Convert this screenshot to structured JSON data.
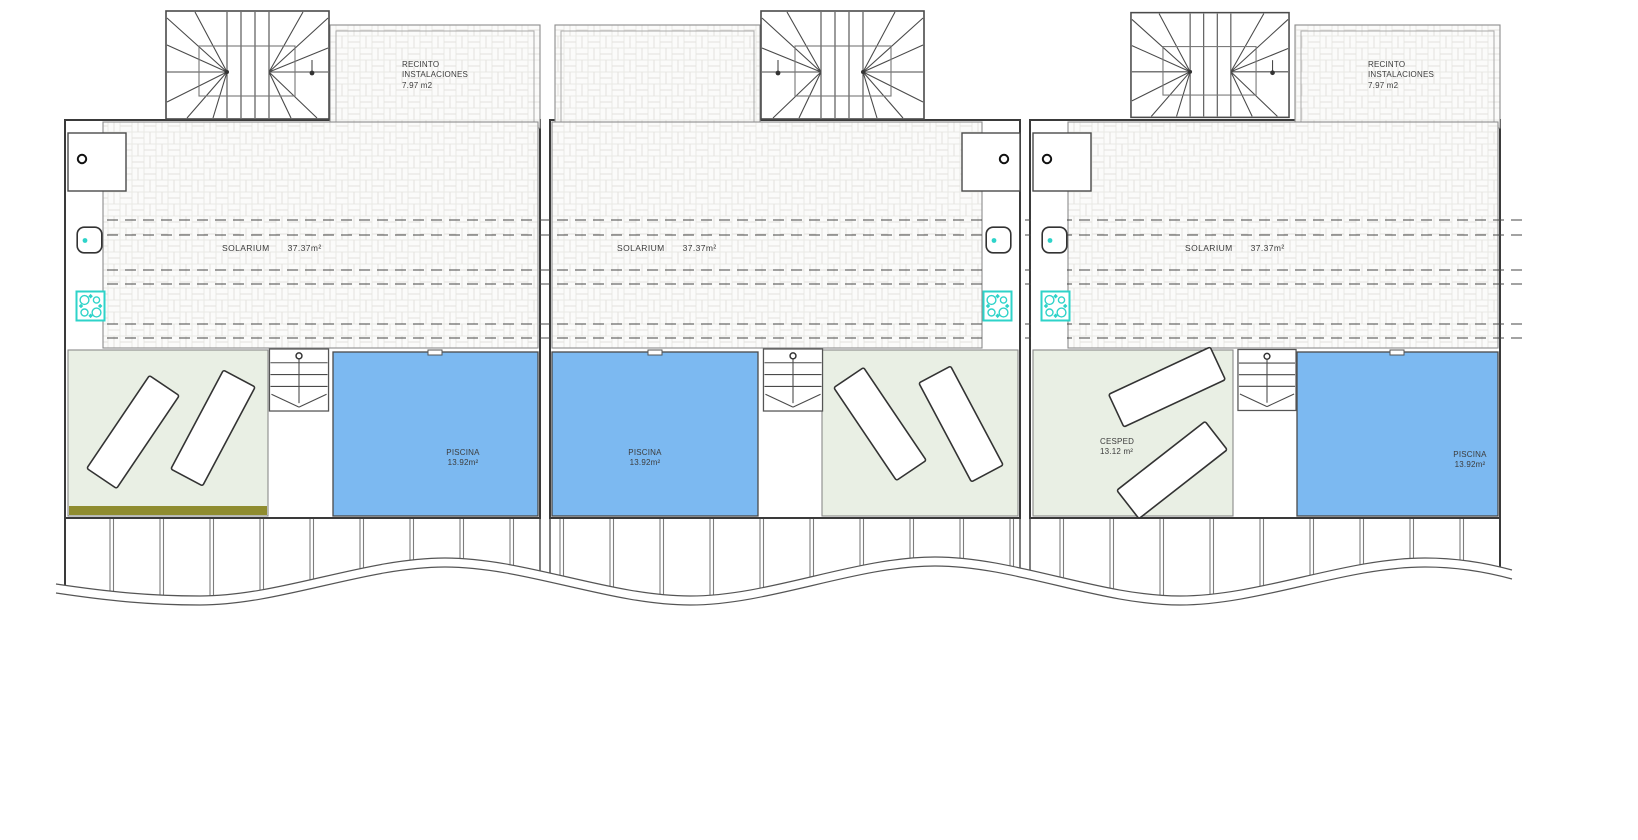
{
  "units": [
    {
      "id": "unit-1",
      "recinto": {
        "text": "RECINTO\nINSTALACIONES\n7.97 m2"
      },
      "solarium": {
        "label": "SOLARIUM",
        "area": "37.37m²"
      },
      "piscina": {
        "label": "PISCINA",
        "area": "13.92m²"
      }
    },
    {
      "id": "unit-2",
      "solarium": {
        "label": "SOLARIUM",
        "area": "37.37m²"
      },
      "piscina": {
        "label": "PISCINA",
        "area": "13.92m²"
      }
    },
    {
      "id": "unit-3",
      "recinto": {
        "text": "RECINTO\nINSTALACIONES\n7.97 m2"
      },
      "solarium": {
        "label": "SOLARIUM",
        "area": "37.37m²"
      },
      "piscina": {
        "label": "PISCINA",
        "area": "13.92m²"
      },
      "cesped": {
        "label": "CESPED",
        "area": "13.12 m²"
      }
    }
  ],
  "colors": {
    "pool": "#7cb9f1",
    "grass": "#e9efe4",
    "fixture_teal": "#2ed3c9",
    "olive_strip": "#8f8c2f",
    "wall_line": "#3a3a3a",
    "hatch_line": "#e3e2dd"
  }
}
